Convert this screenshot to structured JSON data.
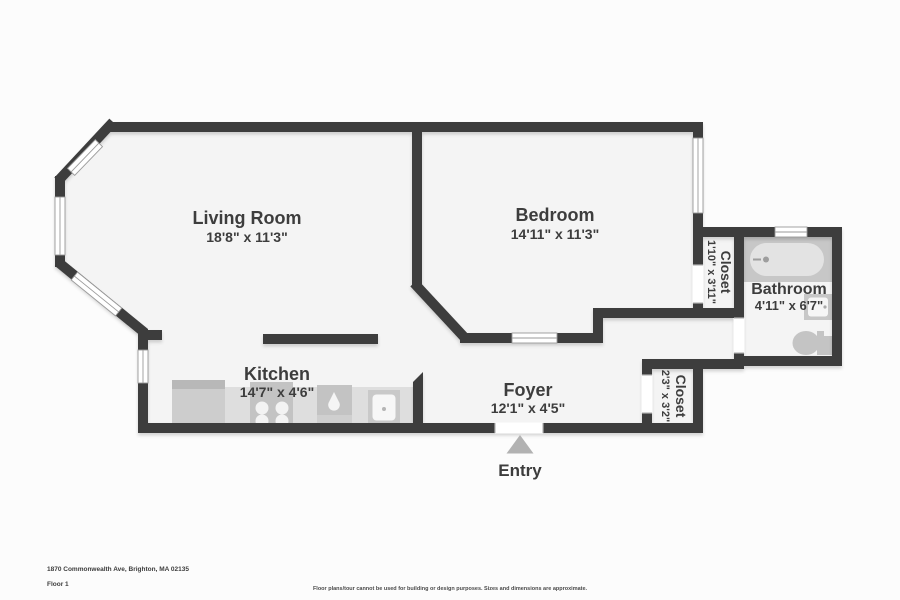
{
  "floorplan": {
    "rooms": {
      "living_room": {
        "name": "Living Room",
        "dims": "18'8\" x 11'3\""
      },
      "bedroom": {
        "name": "Bedroom",
        "dims": "14'11\" x 11'3\""
      },
      "kitchen": {
        "name": "Kitchen",
        "dims": "14'7\" x 4'6\""
      },
      "foyer": {
        "name": "Foyer",
        "dims": "12'1\" x 4'5\""
      },
      "bathroom": {
        "name": "Bathroom",
        "dims": "4'11\" x 6'7\""
      },
      "closet_bedroom": {
        "name": "Closet",
        "dims": "1'10\" x 3'11\""
      },
      "closet_foyer": {
        "name": "Closet",
        "dims": "2'3\" x 3'2\""
      }
    },
    "entry_label": "Entry",
    "colors": {
      "wall": "#3c3c3c",
      "floor": "#f4f4f4",
      "fixture": "#c7c7c7",
      "entry_arrow": "#b2b2b2"
    }
  },
  "footer": {
    "address": "1870 Commonwealth Ave, Brighton, MA 02135",
    "floor": "Floor 1",
    "disclaimer": "Floor plans/tour cannot be used for building or design purposes. Sizes and dimensions are approximate."
  }
}
